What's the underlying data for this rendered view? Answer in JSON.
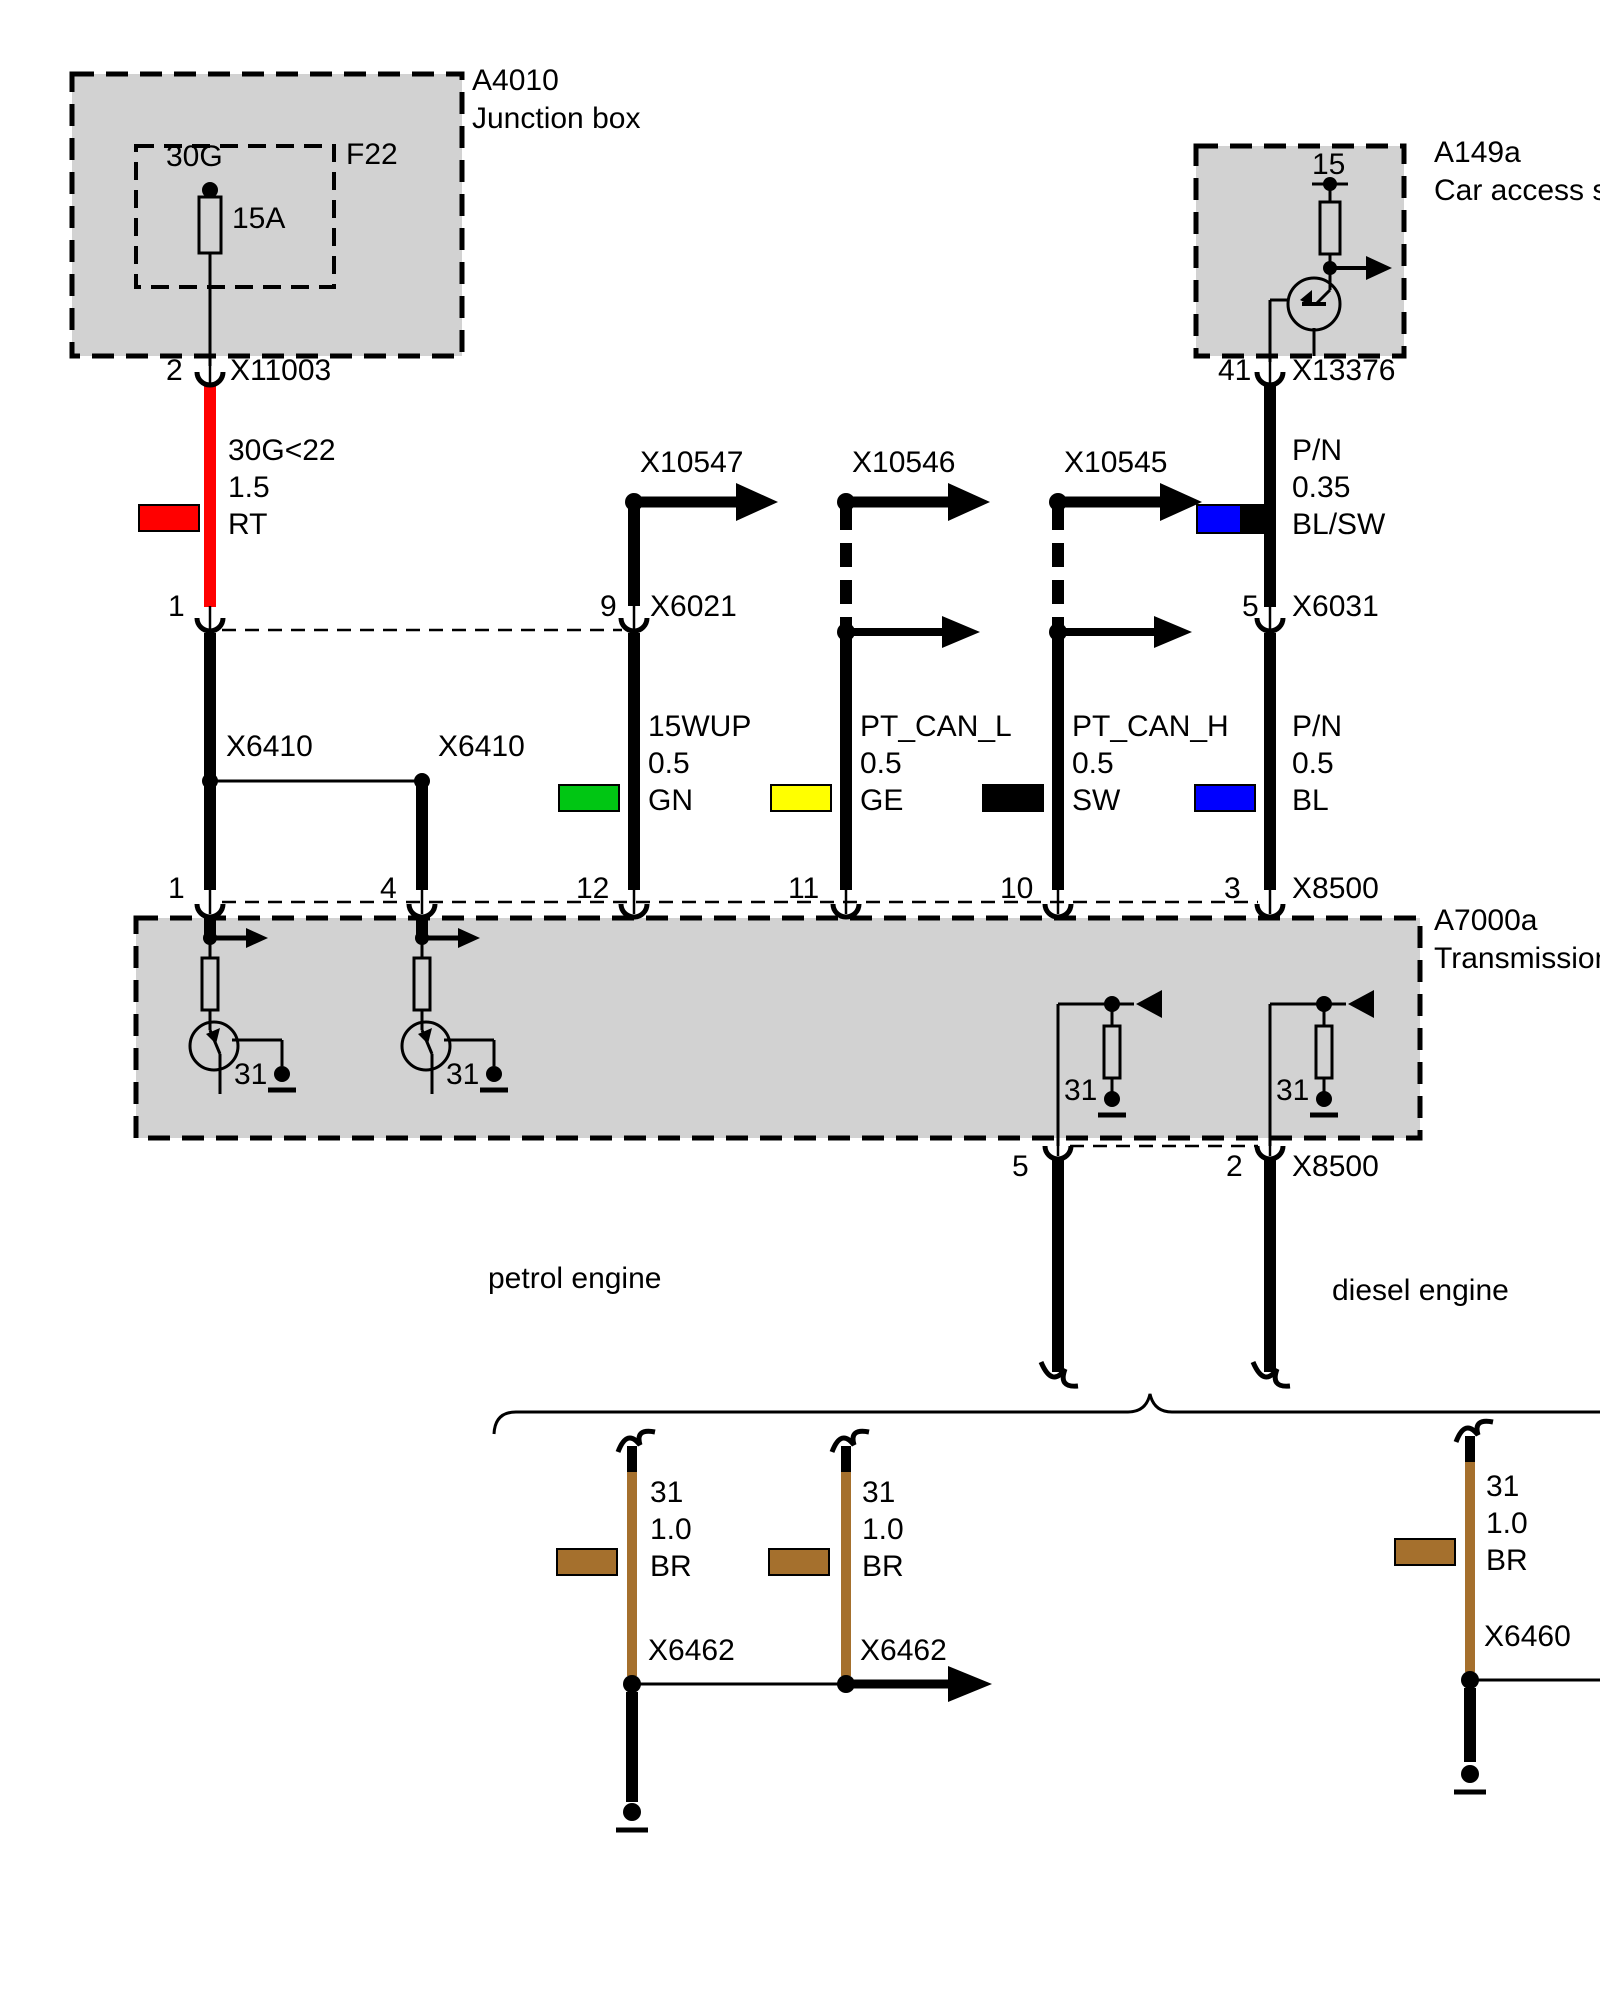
{
  "components": {
    "junction_box": {
      "id": "A4010",
      "name": "Junction box",
      "fuse_box": "F22",
      "fuse_terminal": "30G",
      "fuse_rating": "15A"
    },
    "car_access": {
      "id": "A149a",
      "name": "Car access sys",
      "terminal": "15"
    },
    "transmission": {
      "id": "A7000a",
      "name": "Transmission c",
      "ground_label": "31"
    },
    "engine_variants": {
      "petrol": "petrol engine",
      "diesel": "diesel engine"
    }
  },
  "connectors": {
    "x11003": {
      "label": "X11003",
      "pin": "2",
      "pin_lower": "1"
    },
    "x6021": {
      "label": "X6021",
      "pin": "9"
    },
    "x6031": {
      "label": "X6031",
      "pin": "5"
    },
    "x13376": {
      "label": "X13376",
      "pin": "41"
    },
    "x10547": {
      "label": "X10547"
    },
    "x10546": {
      "label": "X10546"
    },
    "x10545": {
      "label": "X10545"
    },
    "x6410_a": {
      "label": "X6410"
    },
    "x6410_b": {
      "label": "X6410"
    },
    "x8500_top": {
      "label": "X8500",
      "pin_1": "1",
      "pin_4": "4",
      "pin_12": "12",
      "pin_11": "11",
      "pin_10": "10",
      "pin_3": "3"
    },
    "x8500_bottom": {
      "label": "X8500",
      "pin_5": "5",
      "pin_2": "2"
    },
    "x6462_a": {
      "label": "X6462"
    },
    "x6462_b": {
      "label": "X6462"
    },
    "x6460": {
      "label": "X6460"
    }
  },
  "wires": {
    "supply_30g": {
      "circuit": "30G<22",
      "size": "1.5",
      "code": "RT",
      "color": "#ff0000"
    },
    "pn_035": {
      "circuit": "P/N",
      "size": "0.35",
      "code": "BL/SW",
      "color": "#0000ff",
      "color2": "#000000"
    },
    "wup": {
      "circuit": "15WUP",
      "size": "0.5",
      "code": "GN",
      "color": "#00c613"
    },
    "can_l": {
      "circuit": "PT_CAN_L",
      "size": "0.5",
      "code": "GE",
      "color": "#ffff00"
    },
    "can_h": {
      "circuit": "PT_CAN_H",
      "size": "0.5",
      "code": "SW",
      "color": "#000000"
    },
    "pn_05": {
      "circuit": "P/N",
      "size": "0.5",
      "code": "BL",
      "color": "#0000ff"
    },
    "gnd_a": {
      "circuit": "31",
      "size": "1.0",
      "code": "BR",
      "color": "#a5702d"
    },
    "gnd_b": {
      "circuit": "31",
      "size": "1.0",
      "code": "BR",
      "color": "#a5702d"
    },
    "gnd_c": {
      "circuit": "31",
      "size": "1.0",
      "code": "BR",
      "color": "#a5702d"
    }
  }
}
